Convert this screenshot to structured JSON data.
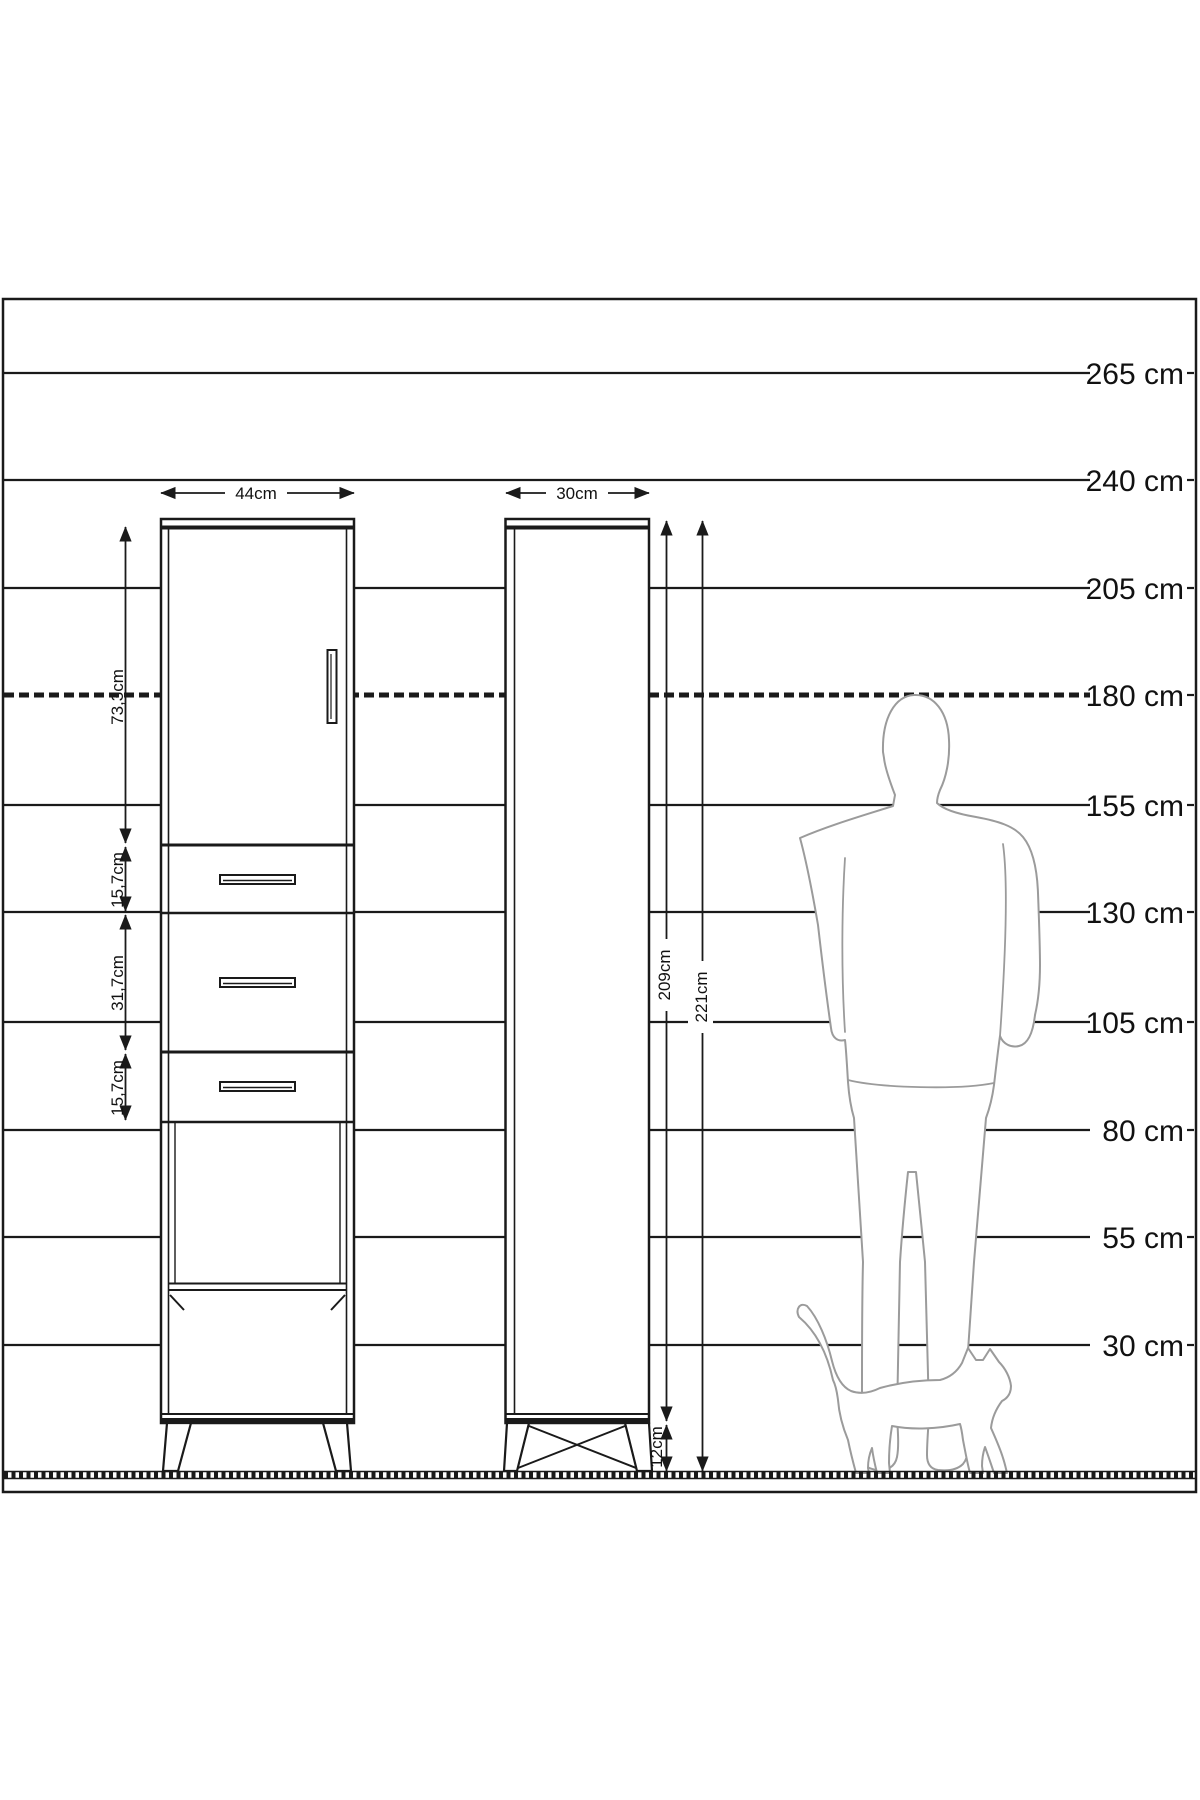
{
  "diagram": {
    "ruler_labels": [
      "265 cm",
      "240 cm",
      "205 cm",
      "180 cm",
      "155 cm",
      "130 cm",
      "105 cm",
      "80 cm",
      "55 cm",
      "30 cm"
    ],
    "front_view": {
      "width": "44cm",
      "section_heights": [
        "73,3cm",
        "15,7cm",
        "31,7cm",
        "15,7cm"
      ]
    },
    "side_view": {
      "depth": "30cm",
      "body_height": "209cm",
      "total_height": "221cm",
      "leg_height": "12cm"
    }
  },
  "colors": {
    "ink": "#1a1a1a",
    "silhouette": "#9b9b9b",
    "background": "#ffffff"
  }
}
